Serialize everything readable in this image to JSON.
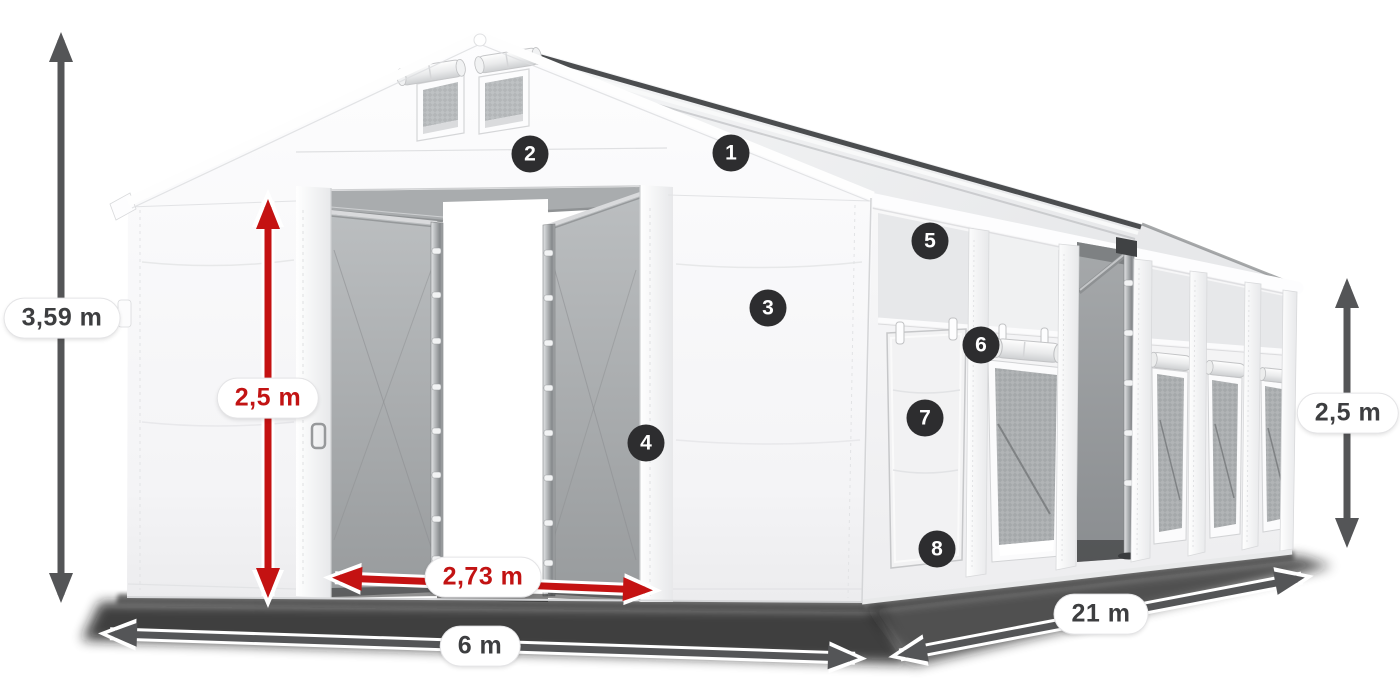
{
  "figure": {
    "subject": "White PVC marquee tent shown in perspective with dimension arrows and numbered feature callouts",
    "background": "#ffffff"
  },
  "dimensions": {
    "total_height": "3,59 m",
    "entrance_height": "2,5 m",
    "entrance_width": "2,73 m",
    "tent_width": "6 m",
    "tent_length": "21 m",
    "side_wall_height": "2,5 m"
  },
  "callouts": [
    "1",
    "2",
    "3",
    "4",
    "5",
    "6",
    "7",
    "8"
  ],
  "colors": {
    "accent_red": "#c21313",
    "arrow_dark": "#545557",
    "badge_background": "#2d2d2f",
    "tent_white": "#f6f6f8",
    "mesh_gray": "#a8abad"
  }
}
